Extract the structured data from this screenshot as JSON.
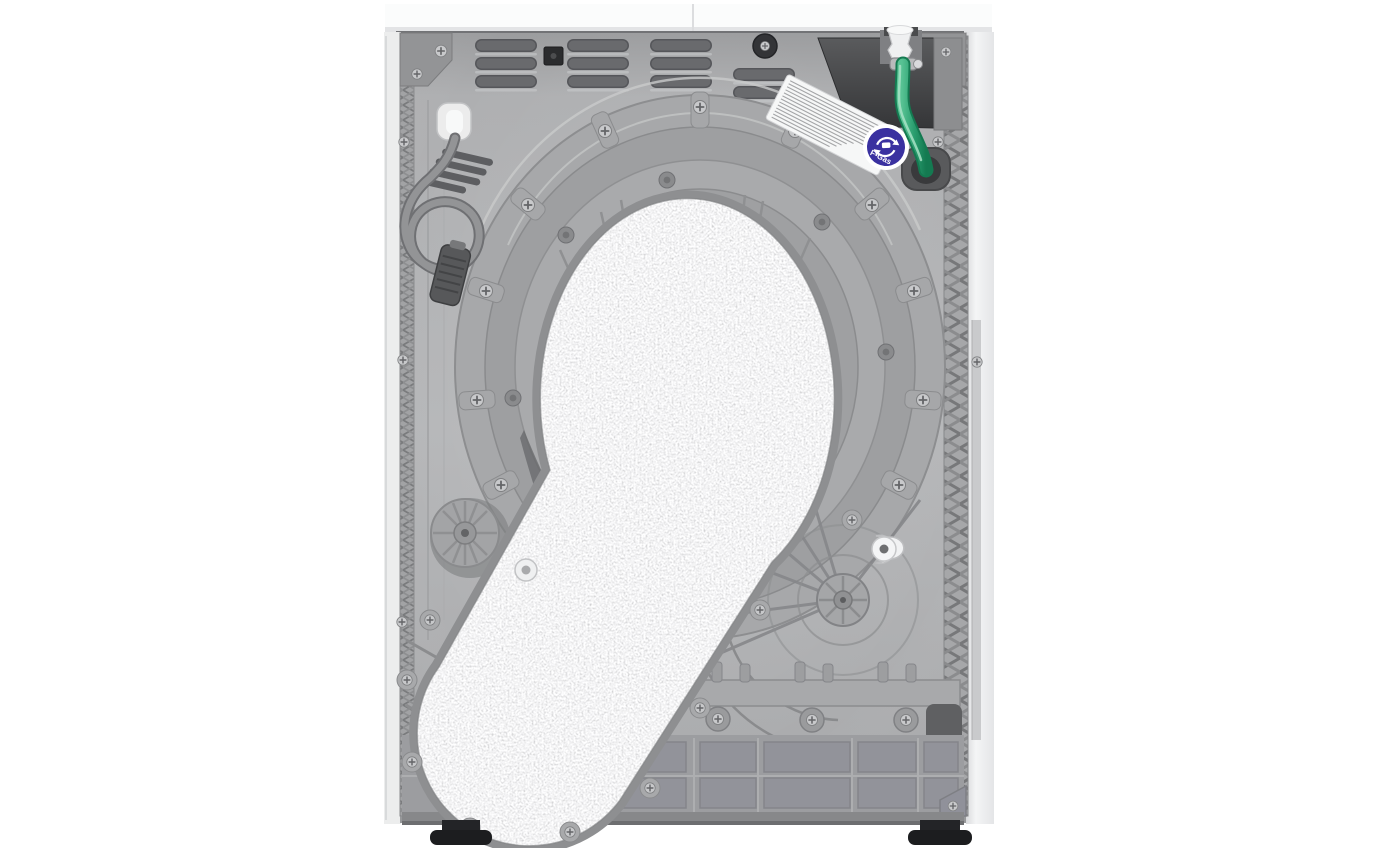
{
  "scene": {
    "type": "product_photograph",
    "subject": "Rear view of a white freestanding heat-pump tumble dryer",
    "orientation": "upright appliance centered on a plain white background"
  },
  "sticker": {
    "text": "F-Gas",
    "disc_color": "#3a31a0",
    "ring_color": "#ffffff",
    "icon": "recycling-arrows-canister-icon"
  },
  "spec_label": {
    "appearance": "white rectangular label, tilted, dense illegible fine print",
    "color": "#f6f7f7"
  },
  "colors": {
    "background": "#ffffff",
    "worktop": "#fbfcfc",
    "side_panels": "#f1f2f3",
    "back_panel": "#b2b3b5",
    "drum_housing": "#a5a6a8",
    "felt_duct": "#d8d9da",
    "base_frame": "#9b9c9e",
    "heat_pump_box": "#47484a",
    "drain_hose": "#2a9e6f",
    "power_cable": "#8f9092",
    "plug": "#525356",
    "feet": "#1c1d1f"
  },
  "counts": {
    "adjustable_feet_visible": 2,
    "vent_slot_rows": 3,
    "drum_housing_rings": 4
  },
  "parts": [
    "worktop",
    "side-panels",
    "back-panel",
    "ventilation-slots",
    "power-cord-with-plug",
    "drum-housing",
    "felt-covered-air-duct",
    "heat-pump-compartment",
    "condensate-drain-hose",
    "spec-label",
    "f-gas-sticker",
    "base-frame",
    "adjustable-feet"
  ]
}
